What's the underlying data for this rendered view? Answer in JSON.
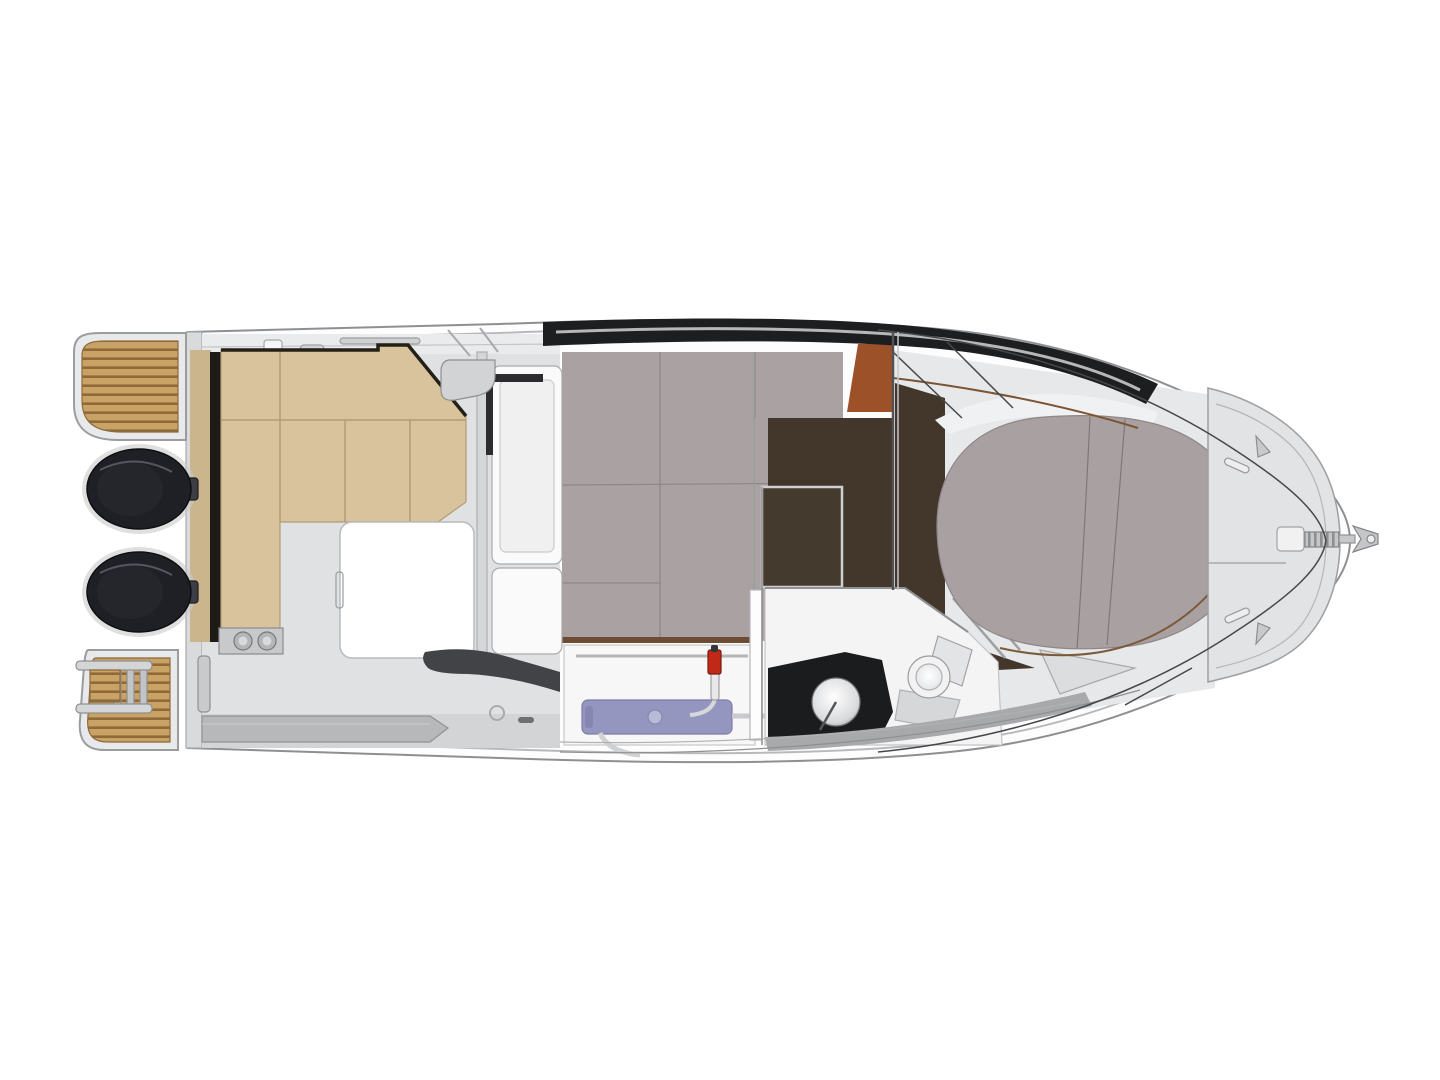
{
  "diagram": {
    "title": "Motorboat deck plan — overhead interior layout, bow to the right",
    "type": "boat-floor-plan",
    "view": "top-down",
    "background": "#ffffff",
    "components": [
      {
        "id": "swim-platform-port",
        "label": "teak swim platform (top left)"
      },
      {
        "id": "swim-platform-starboard",
        "label": "teak swim platform with boarding ladder (bottom left)"
      },
      {
        "id": "boarding-ladder",
        "label": "telescopic boarding ladder"
      },
      {
        "id": "outboard-engine-port",
        "label": "outboard engine"
      },
      {
        "id": "outboard-engine-starboard",
        "label": "outboard engine"
      },
      {
        "id": "cockpit",
        "label": "aft cockpit"
      },
      {
        "id": "aft-bench-seating",
        "label": "L-shaped cockpit bench seating"
      },
      {
        "id": "cockpit-table",
        "label": "cockpit table"
      },
      {
        "id": "cupholder-plate",
        "label": "bench end plate with two cup holders"
      },
      {
        "id": "wheelhouse-door",
        "label": "sliding wheelhouse door"
      },
      {
        "id": "cabin-berth-carpet",
        "label": "aft cabin berth (grey upholstery)"
      },
      {
        "id": "helm-seat",
        "label": "helm seat (terracotta)"
      },
      {
        "id": "cabin-wood-floor",
        "label": "dark wood cabin sole"
      },
      {
        "id": "floor-hatch",
        "label": "framed floor hatch"
      },
      {
        "id": "galley-counter",
        "label": "galley counter"
      },
      {
        "id": "galley-sink-unit",
        "label": "galley sink module"
      },
      {
        "id": "galley-faucet",
        "label": "galley faucet with red handle"
      },
      {
        "id": "head-compartment",
        "label": "head / bathroom"
      },
      {
        "id": "head-sink",
        "label": "round washbasin on dark counter"
      },
      {
        "id": "toilet",
        "label": "marine toilet"
      },
      {
        "id": "v-berth",
        "label": "forward V-berth cushion"
      },
      {
        "id": "bow-deck",
        "label": "bow deck with anchor locker"
      },
      {
        "id": "anchor-roller",
        "label": "bow roller and anchor"
      },
      {
        "id": "bow-rail",
        "label": "bow pulpit rail"
      }
    ]
  },
  "colors": {
    "hull_outline": "#8e8f92",
    "hull_fill": "#fdfdfd",
    "deck_light": "#e0e1e3",
    "gunwale_dark": "#1d1e20",
    "band_gray": "#a8a9ab",
    "teak": "#c9a265",
    "teak_stripe": "#8f6a38",
    "engine_dark": "#1e2026",
    "cushion_beige": "#d9c39d",
    "cushion_seam": "#b39b73",
    "carpet_gray": "#a9a1a2",
    "berth_gray": "#a9a0a2",
    "wood_dark": "#43372c",
    "wood_trim": "#6e4c34",
    "helm_terracotta": "#9c5128",
    "galley_purple": "#9596c0",
    "head_counter_black": "#1b1c1e",
    "faucet_red": "#c02818",
    "table_white": "#ffffff"
  }
}
